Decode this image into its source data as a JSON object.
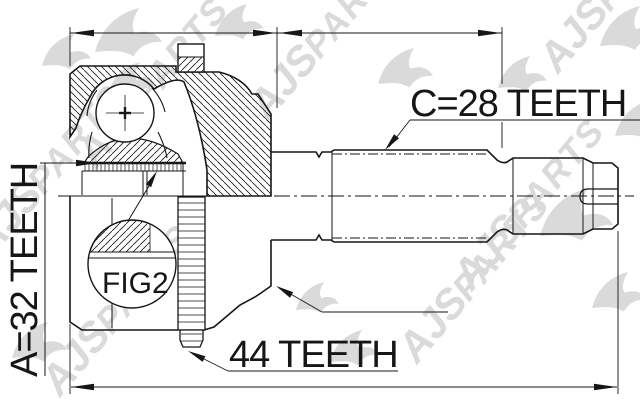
{
  "drawing": {
    "figure_label": "FIG2",
    "labels": {
      "shaft_spline": "C=28 TEETH",
      "hub_spline": "A=32 TEETH",
      "abs_ring": "44 TEETH"
    },
    "colors": {
      "line": "#161616",
      "background": "#ffffff",
      "watermark": "#b5b5b5"
    }
  },
  "watermark": {
    "brand": "AJS",
    "word": "PARTS"
  }
}
